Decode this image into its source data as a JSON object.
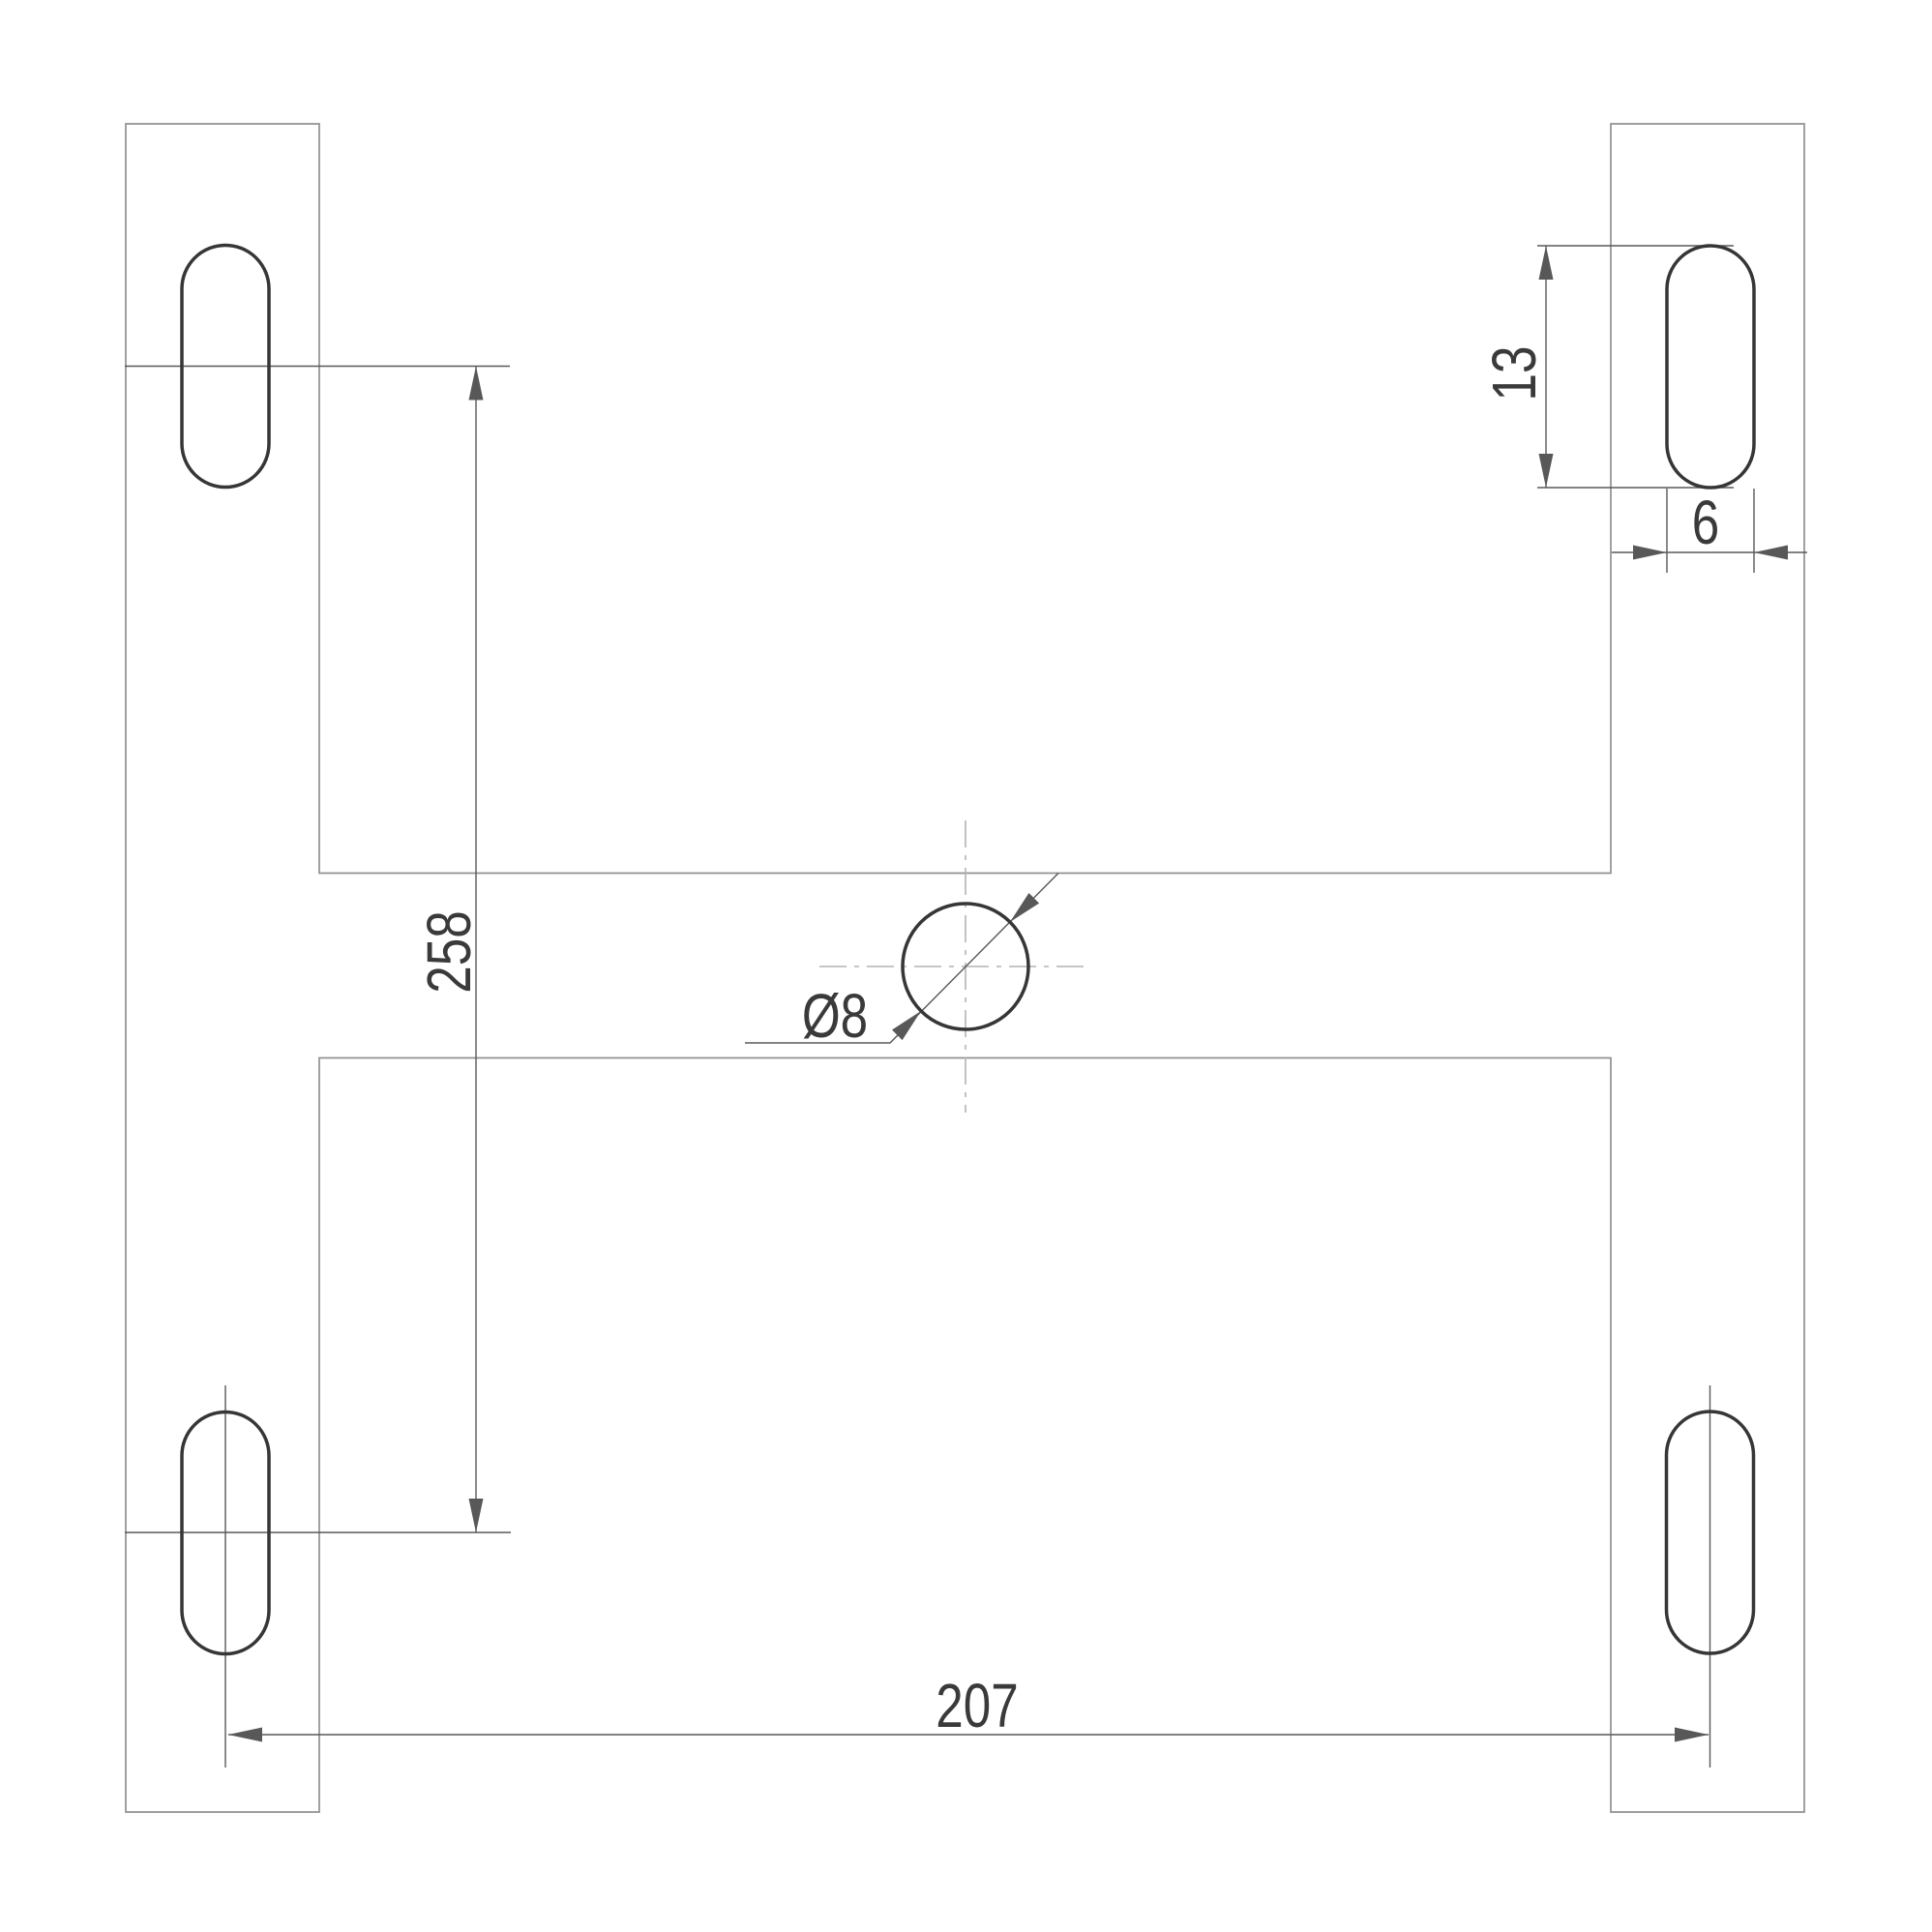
{
  "drawing": {
    "description": "Engineering dimension drawing: H-shaped mounting plate with four obround slots and a central round hole",
    "background": "#ffffff"
  },
  "colors": {
    "outline": "#919191",
    "feature": "#363636",
    "dimension": "#585858",
    "centerline": "#b4b4b4",
    "label": "#3a3a3a"
  },
  "dimensions": {
    "slot_pitch_vertical": {
      "label": "258",
      "value": 258
    },
    "slot_pitch_horizontal": {
      "label": "207",
      "value": 207
    },
    "slot_length": {
      "label": "13",
      "value": 13
    },
    "slot_width": {
      "label": "6",
      "value": 6
    },
    "center_hole_diameter": {
      "label": "Ø8",
      "value": 8
    }
  }
}
